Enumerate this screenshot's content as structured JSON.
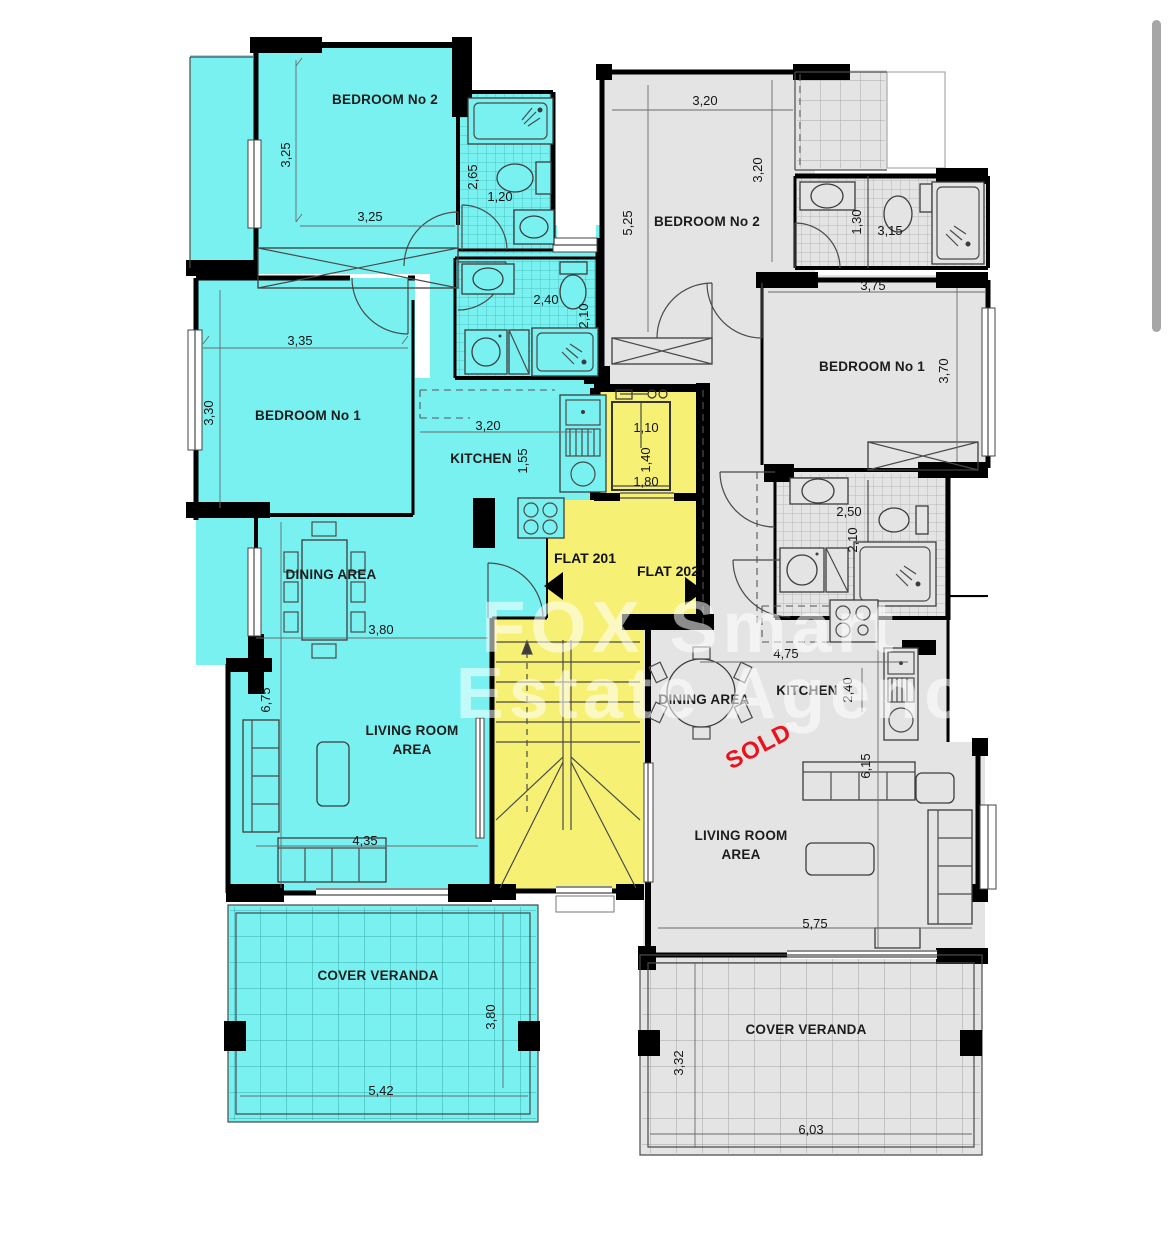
{
  "colors": {
    "flat201_fill": "#79f1f1",
    "flat202_fill": "#e4e4e4",
    "common_fill": "#f6f175",
    "wall": "#000000",
    "sold": "#e8131d",
    "scrollbar": "#a6a6a6"
  },
  "watermark": {
    "line1": "FOX Smart",
    "line2": "Estate Agency"
  },
  "core": {
    "flat201_label": "FLAT 201",
    "flat202_label": "FLAT 202",
    "elevator_width": "1,10",
    "elevator_depth": "1,40",
    "elevator_shaft": "1,80"
  },
  "flat201": {
    "bedroom2": {
      "label": "BEDROOM No 2",
      "width": "3,25",
      "height": "3,25"
    },
    "bath1": {
      "height": "2,65",
      "width": "1,20"
    },
    "bath2": {
      "width": "2,40",
      "height": "2,10"
    },
    "bedroom1": {
      "label": "BEDROOM No 1",
      "width": "3,35",
      "height": "3,30"
    },
    "kitchen": {
      "label": "KITCHEN",
      "width": "3,20",
      "height": "1,55"
    },
    "dining": {
      "label": "DINING AREA",
      "width": "3,80"
    },
    "living": {
      "label_line1": "LIVING ROOM",
      "label_line2": "AREA",
      "height": "6,75",
      "width": "4,35"
    },
    "veranda": {
      "label": "COVER VERANDA",
      "width": "5,42",
      "height": "3,80"
    }
  },
  "flat202": {
    "status": "SOLD",
    "bedroom2": {
      "label": "BEDROOM No 2",
      "width": "3,20",
      "height": "5,25",
      "height2": "3,20"
    },
    "bath1": {
      "height": "1,30",
      "width": "3,15"
    },
    "bedroom1": {
      "label": "BEDROOM No 1",
      "width": "3,75",
      "height": "3,70"
    },
    "bath2": {
      "width": "2,50",
      "height": "2,10"
    },
    "kitchen": {
      "label": "KITCHEN",
      "width": "4,75",
      "height": "2,40"
    },
    "dining": {
      "label": "DINING AREA"
    },
    "living": {
      "label_line1": "LIVING ROOM",
      "label_line2": "AREA",
      "height": "6,15",
      "width": "5,75"
    },
    "veranda": {
      "label": "COVER VERANDA",
      "width": "6,03",
      "height": "3,32"
    }
  }
}
